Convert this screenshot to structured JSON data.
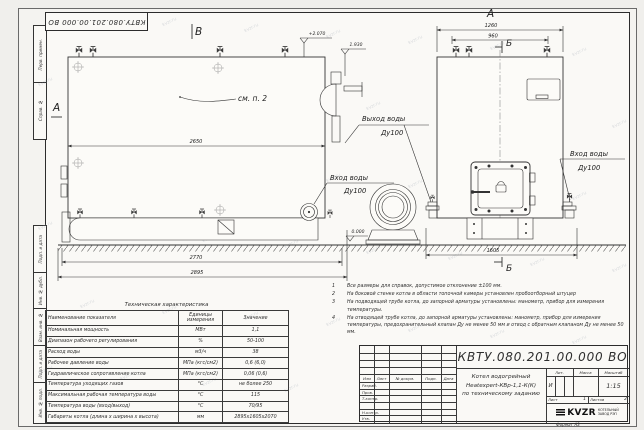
{
  "watermark": "kvzr.ru",
  "side_strip": {
    "top": [
      "Перв. примен.",
      "Справ. №"
    ],
    "bottom": [
      "Подп. и дата",
      "Инв. № дубл.",
      "Взам. инв. №",
      "Подп. и дата",
      "Инв. № подл."
    ]
  },
  "drawing": {
    "view_b": "В",
    "section_a": "А",
    "view_a": "А",
    "section_b": "Б",
    "callout": "см. п. 2",
    "elev_top": "+2.070",
    "elev_fan": "1.930",
    "elev_zero": "0.000",
    "dim_body": "2650",
    "dim_base": "2770",
    "dim_total": "2895",
    "dim_front_top": "1260",
    "dim_front_inner": "960",
    "dim_front_base": "1605",
    "outlet_label": "Выход воды",
    "outlet_dn": "Ду100",
    "inlet_label": "Вход воды",
    "inlet_dn": "Ду100"
  },
  "notes": [
    {
      "num": "1",
      "text": "Все размеры для справок, допустимое отклонение  ±100 мм."
    },
    {
      "num": "2",
      "text": "На боковой стенке котла в области топочной камеры установлен пробоотборный штуцер"
    },
    {
      "num": "3",
      "text": "На  подводящей трубе котла, до запорной арматуры установлены: манометр, прибор для измерения температуры."
    },
    {
      "num": "4",
      "text": "На отводящей трубе котла, до запорной арматуры установлены: манометр, прибор для измерения температуры, предохранительный клапан  Ду не менее 50 мм и отвод с обратным клапаном  Ду не менее 50 мм."
    }
  ],
  "table": {
    "title": "Техническая характеристика",
    "headers": [
      "Наименование показателя",
      "Единицы измерения",
      "Значение"
    ],
    "rows": [
      [
        "Номинальная мощность",
        "МВт",
        "1,1"
      ],
      [
        "Диапазон рабочего регулирования",
        "%",
        "50-100"
      ],
      [
        "Расход воды",
        "м3/ч",
        "38"
      ],
      [
        "Рабочее давление воды",
        "МПа (кгс/см2)",
        "0,6 (6,0)"
      ],
      [
        "Гидравлическое сопротивление котла",
        "МПа (кгс/см2)",
        "0,06 (0,6)"
      ],
      [
        "Температура уходящих газов",
        "°С",
        "не более 250"
      ],
      [
        "Максимальная рабочая температура воды",
        "°С",
        "115"
      ],
      [
        "Температура воды (вход/выход)",
        "°С",
        "70/95"
      ],
      [
        "Габариты котла (длина х ширина х высота)",
        "мм",
        "2895х1605х2070"
      ]
    ]
  },
  "title_block": {
    "doc_number": "КВТУ.080.201.00.000  ВО",
    "product_lines": [
      "Котел водогрейный",
      "Heatexpert-КВр-1,1-К(К)",
      "по техническому заданию"
    ],
    "rev_header": [
      "Изм",
      "Лист",
      "№ докум.",
      "Подп.",
      "Дата"
    ],
    "sign_rows": [
      "Разраб.",
      "Пров.",
      "Т.контр.",
      "Н.контр.",
      "Утв."
    ],
    "lit_header": [
      "Лит.",
      "Масса",
      "Масштаб"
    ],
    "lit": "И",
    "scale": "1:15",
    "sheet_label": "Лист",
    "sheet_value": "1",
    "sheets_label": "Листов",
    "sheets_value": "2",
    "company": {
      "logo": "KVZR",
      "name_lines": [
        "КОТЕЛЬНЫЙ",
        "ЗАВОД РЭП"
      ]
    }
  },
  "format_label": "Формат  А3"
}
